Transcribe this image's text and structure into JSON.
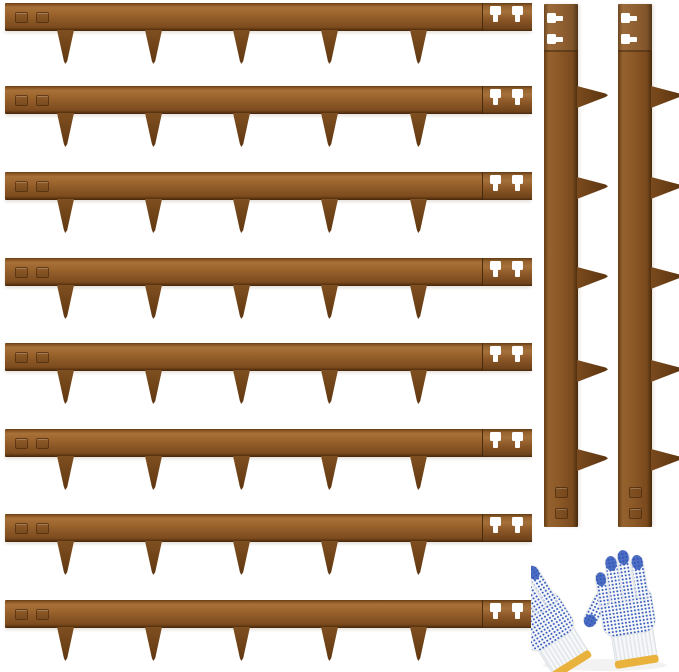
{
  "canvas": {
    "width": 679,
    "height": 672,
    "background": "#ffffff"
  },
  "product": {
    "scene": "corten-steel-landscape-edging-kit-with-gloves",
    "horizontal_strip_count": 8,
    "vertical_strip_count": 2,
    "spikes_per_strip": 5,
    "glove_pair_count": 1
  },
  "colors": {
    "steel_light": "#a8713a",
    "steel_mid": "#8a5726",
    "steel_dark": "#6a3f15",
    "steel_edge": "#46280c",
    "slot_white": "#ffffff",
    "glove_white": "#f7f8f9",
    "glove_knit_shadow": "#e2e6ea",
    "glove_dot_blue": "#3a5fbe",
    "glove_tip_blue": "#2f55b8",
    "glove_trim_yellow": "#e8b23c"
  },
  "horizontal_strips": {
    "left": 5,
    "bar_width": 526,
    "bar_height": 28,
    "row_tops": [
      3,
      86,
      172,
      258,
      343,
      429,
      514,
      600
    ],
    "spike_centers_x": [
      61,
      149,
      237,
      325,
      414
    ],
    "spike_width": 17,
    "spike_length": 34,
    "connector_left": 477,
    "connector_width": 49,
    "keyhole_lefts": [
      485,
      507
    ],
    "keyhole_top": 3,
    "stamp_lefts": [
      10,
      31
    ],
    "stamp_top": 9,
    "stamp_width": 11,
    "stamp_height": 9
  },
  "vertical_strips": {
    "lefts": [
      544,
      618
    ],
    "top": 4,
    "width": 34,
    "height": 523,
    "connector_height": 46,
    "keyhole_left": 3,
    "keyhole_tops": [
      9,
      30
    ],
    "spike_centers_y": [
      93,
      184,
      274,
      367,
      456
    ],
    "spike_length": 31,
    "spike_base": 22,
    "stamp_left": 11,
    "stamp_tops": [
      483,
      504
    ],
    "stamp_width": 11,
    "stamp_height": 9
  },
  "gloves": {
    "left": 531,
    "top": 532,
    "width": 148,
    "height": 140
  }
}
